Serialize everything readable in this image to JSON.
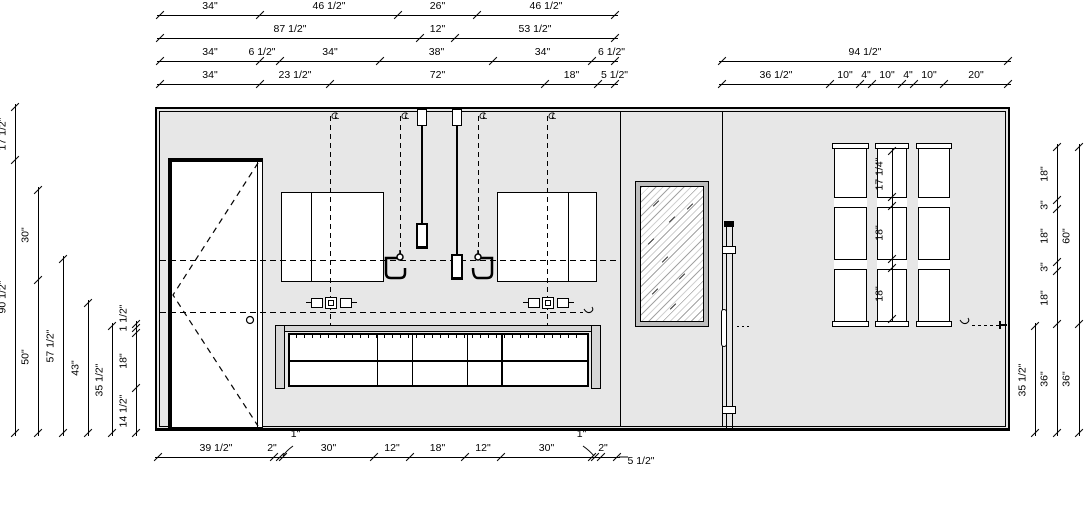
{
  "drawing": {
    "type": "interior-elevation",
    "units": "inches",
    "elements": [
      "door",
      "medicine-cabinets",
      "pendant-lights",
      "wall-faucets",
      "vanity-cabinet",
      "countertop",
      "mirror",
      "glass-door-edge",
      "shelf-towers",
      "outlets",
      "paper-holder"
    ]
  },
  "colors": {
    "wall_fill": "#e7e7e7",
    "counter_fill": "#d6d6d6",
    "mirror_frame": "#bdbdbd",
    "line": "#000000",
    "hatch": "#a3a3a3"
  },
  "annotations": {
    "centerline_symbol": "CL"
  },
  "dimension_lines": {
    "top_left_rows": [
      {
        "labels": [
          "34\"",
          "46 1/2\"",
          "26\"",
          "46 1/2\""
        ]
      },
      {
        "labels": [
          "87 1/2\"",
          "12\"",
          "53 1/2\""
        ]
      },
      {
        "labels": [
          "34\"",
          "6 1/2\"",
          "34\"",
          "38\"",
          "34\"",
          "6 1/2\""
        ]
      },
      {
        "labels": [
          "34\"",
          "23 1/2\"",
          "72\"",
          "18\"",
          "5 1/2\""
        ]
      }
    ],
    "top_right_rows": [
      {
        "labels": [
          "94 1/2\""
        ]
      },
      {
        "labels": [
          "36 1/2\"",
          "10\"",
          "4\"",
          "10\"",
          "4\"",
          "10\"",
          "20\""
        ]
      }
    ],
    "left_columns": [
      {
        "labels": [
          "17 1/2\"",
          "90 1/2\""
        ]
      },
      {
        "labels": [
          "30\"",
          "50\""
        ]
      },
      {
        "labels": [
          "57 1/2\""
        ]
      },
      {
        "labels": [
          "43\""
        ]
      },
      {
        "labels": [
          "35 1/2\""
        ]
      },
      {
        "labels": [
          "1 1/2\"",
          "",
          "18\"",
          "14 1/2\""
        ]
      }
    ],
    "right_columns": [
      {
        "labels": [
          "35 1/2\""
        ]
      },
      {
        "labels": [
          "18\"",
          "3\"",
          "18\"",
          "3\"",
          "18\"",
          "36\""
        ]
      },
      {
        "labels": [
          "60\"",
          "36\""
        ]
      }
    ],
    "bottom_rows": [
      {
        "labels": [
          "39 1/2\"",
          "2\"",
          "1\"",
          "30\"",
          "12\"",
          "18\"",
          "12\"",
          "30\"",
          "1\"",
          "2\"",
          "5 1/2\""
        ]
      }
    ],
    "shelf_tower_column": [
      {
        "labels": [
          "17 1/4\"",
          "",
          "18\"",
          "",
          "18\""
        ]
      }
    ]
  }
}
